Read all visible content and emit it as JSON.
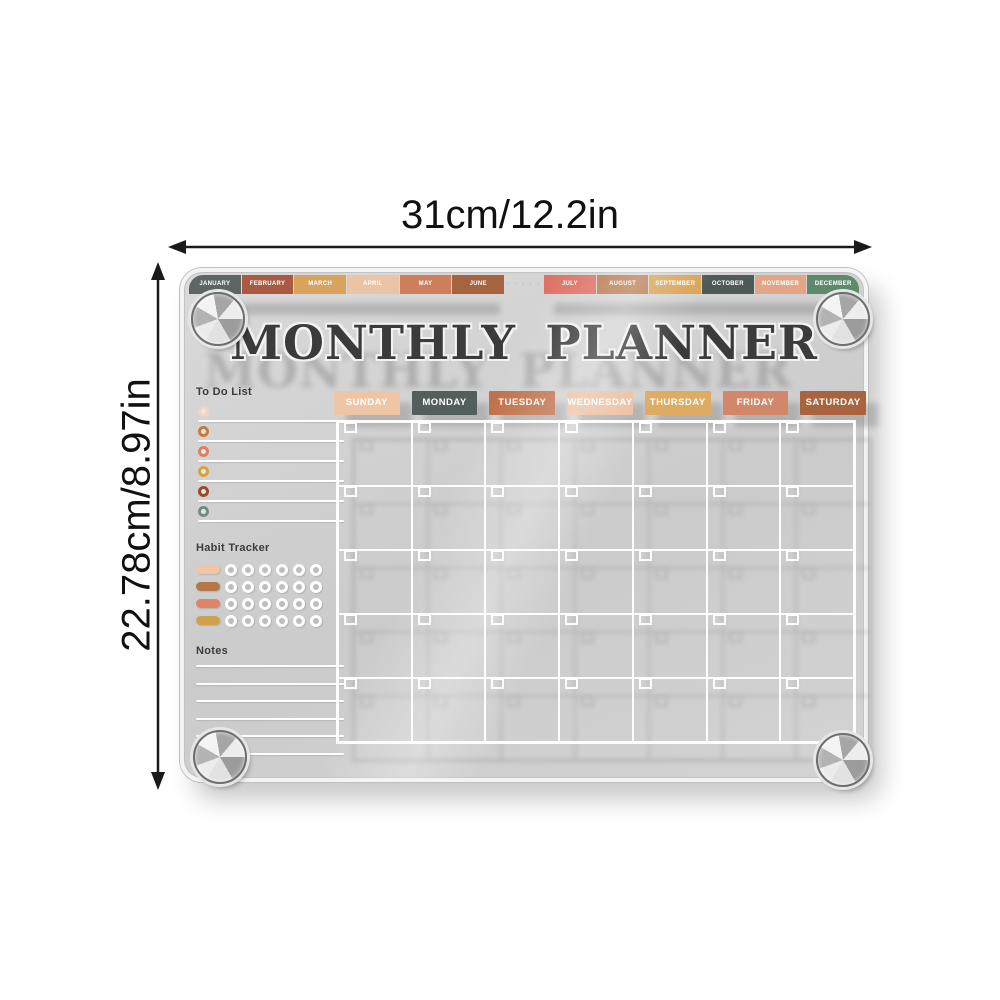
{
  "dimensions": {
    "width_label": "31cm/12.2in",
    "height_label": "22.78cm/8.97in"
  },
  "board": {
    "title": "MONTHLY PLANNER",
    "tab_gap_dots": "· ·  · · ·",
    "months": [
      {
        "label": "JANUARY",
        "color": "#5d6664"
      },
      {
        "label": "FEBRUARY",
        "color": "#a85a43"
      },
      {
        "label": "MARCH",
        "color": "#d8a45d"
      },
      {
        "label": "APRIL",
        "color": "#eac4a4"
      },
      {
        "label": "MAY",
        "color": "#cd7f5d"
      },
      {
        "label": "JUNE",
        "color": "#a3643f"
      },
      {
        "label": "JULY",
        "color": "#dd7265"
      },
      {
        "label": "AUGUST",
        "color": "#b87a50"
      },
      {
        "label": "SEPTEMBER",
        "color": "#d8a354"
      },
      {
        "label": "OCTOBER",
        "color": "#4e5a58"
      },
      {
        "label": "NOVEMBER",
        "color": "#e2a588"
      },
      {
        "label": "DECEMBER",
        "color": "#5c8a6b"
      }
    ],
    "days": [
      {
        "label": "SUNDAY",
        "color": "#eec6a6"
      },
      {
        "label": "MONDAY",
        "color": "#535f5c"
      },
      {
        "label": "TUESDAY",
        "color": "#c0704a"
      },
      {
        "label": "WEDNESDAY",
        "color": "#eac0a0"
      },
      {
        "label": "THURSDAY",
        "color": "#ddab62"
      },
      {
        "label": "FRIDAY",
        "color": "#d3876a"
      },
      {
        "label": "SATURDAY",
        "color": "#a9643f"
      }
    ],
    "todo": {
      "heading": "To Do List",
      "bullet_colors": [
        "#f2d5c0",
        "#c97840",
        "#e08060",
        "#d4a43f",
        "#9c4a2a",
        "#6b9080"
      ]
    },
    "habit": {
      "heading": "Habit Tracker",
      "pill_colors": [
        "#efc5a5",
        "#b5764a",
        "#e08468",
        "#cfa14e"
      ],
      "circles_per_row": 6
    },
    "notes": {
      "heading": "Notes",
      "lines": 6
    },
    "calendar": {
      "rows": 5,
      "cols": 7
    }
  }
}
